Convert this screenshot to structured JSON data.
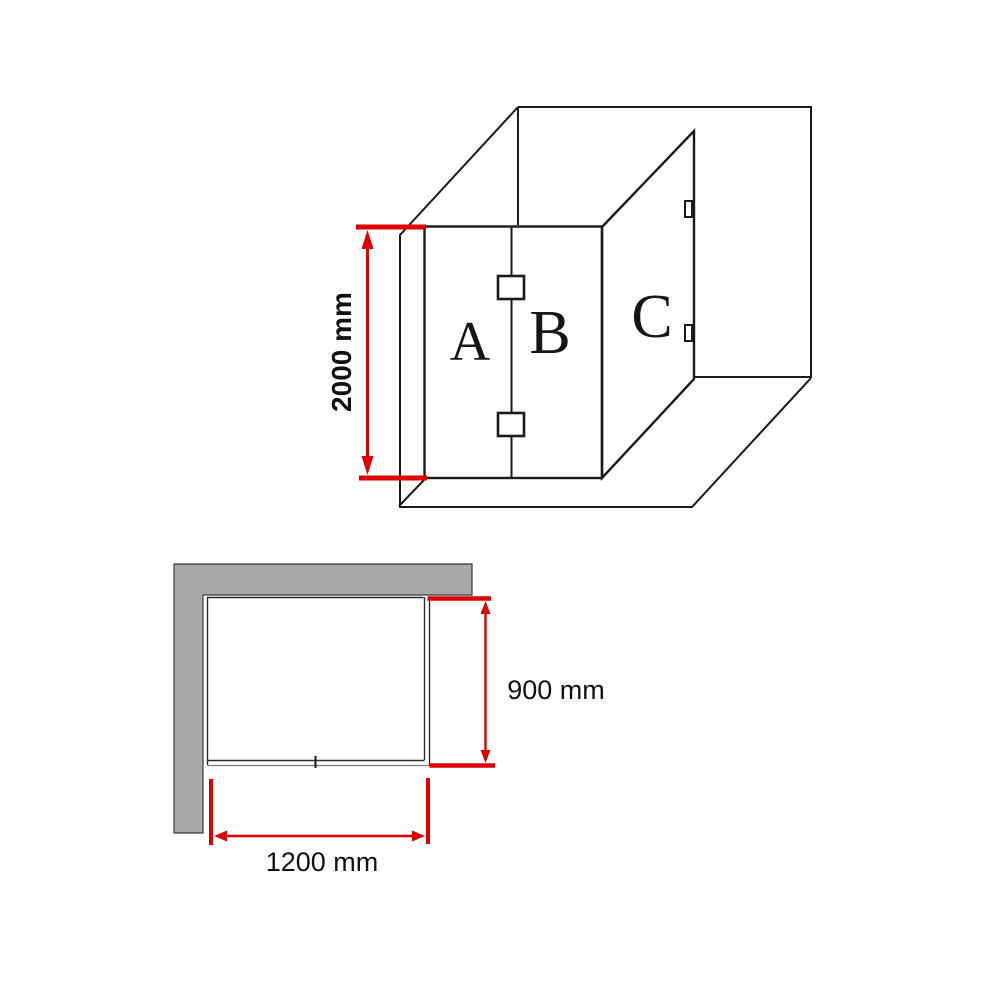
{
  "diagram": {
    "kind": "corner-shower-screen-installation-dimensions",
    "colors": {
      "glass_panel": "#d9d9d9",
      "wall": "#a9a9a9",
      "outline": "#1a1a1a",
      "dimension_red": "#dd0000",
      "background": "#ffffff"
    },
    "perspective_view": {
      "panel_labels": {
        "a": "A",
        "b": "B",
        "c": "C"
      },
      "height_dimension": "2000 mm"
    },
    "plan_view": {
      "depth_dimension": "900 mm",
      "width_dimension": "1200 mm"
    }
  }
}
